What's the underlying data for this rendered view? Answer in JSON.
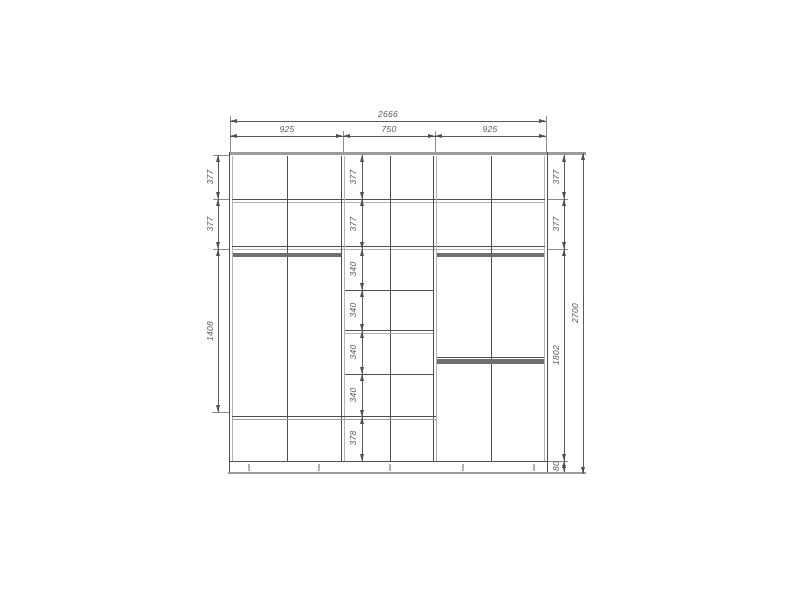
{
  "drawing": {
    "title": "wardrobe-front-elevation-dimension-drawing",
    "units": "mm",
    "overall": {
      "width": "2666",
      "height": "2700"
    },
    "top_chain": {
      "total": "2666",
      "segments": [
        "925",
        "750",
        "925"
      ]
    },
    "left_chain": [
      "377",
      "377",
      "1408"
    ],
    "middle_chain": [
      "377",
      "377",
      "340",
      "340",
      "340",
      "340",
      "378"
    ],
    "right_chain": [
      "377",
      "377",
      "1802",
      "80"
    ],
    "right_total": "2700"
  },
  "colors": {
    "background": "#ffffff",
    "line": "#4f4f4f",
    "panel_thick": "#6f6f6f",
    "light_gray": "#9c9c9c",
    "text": "#5a5a5a"
  }
}
